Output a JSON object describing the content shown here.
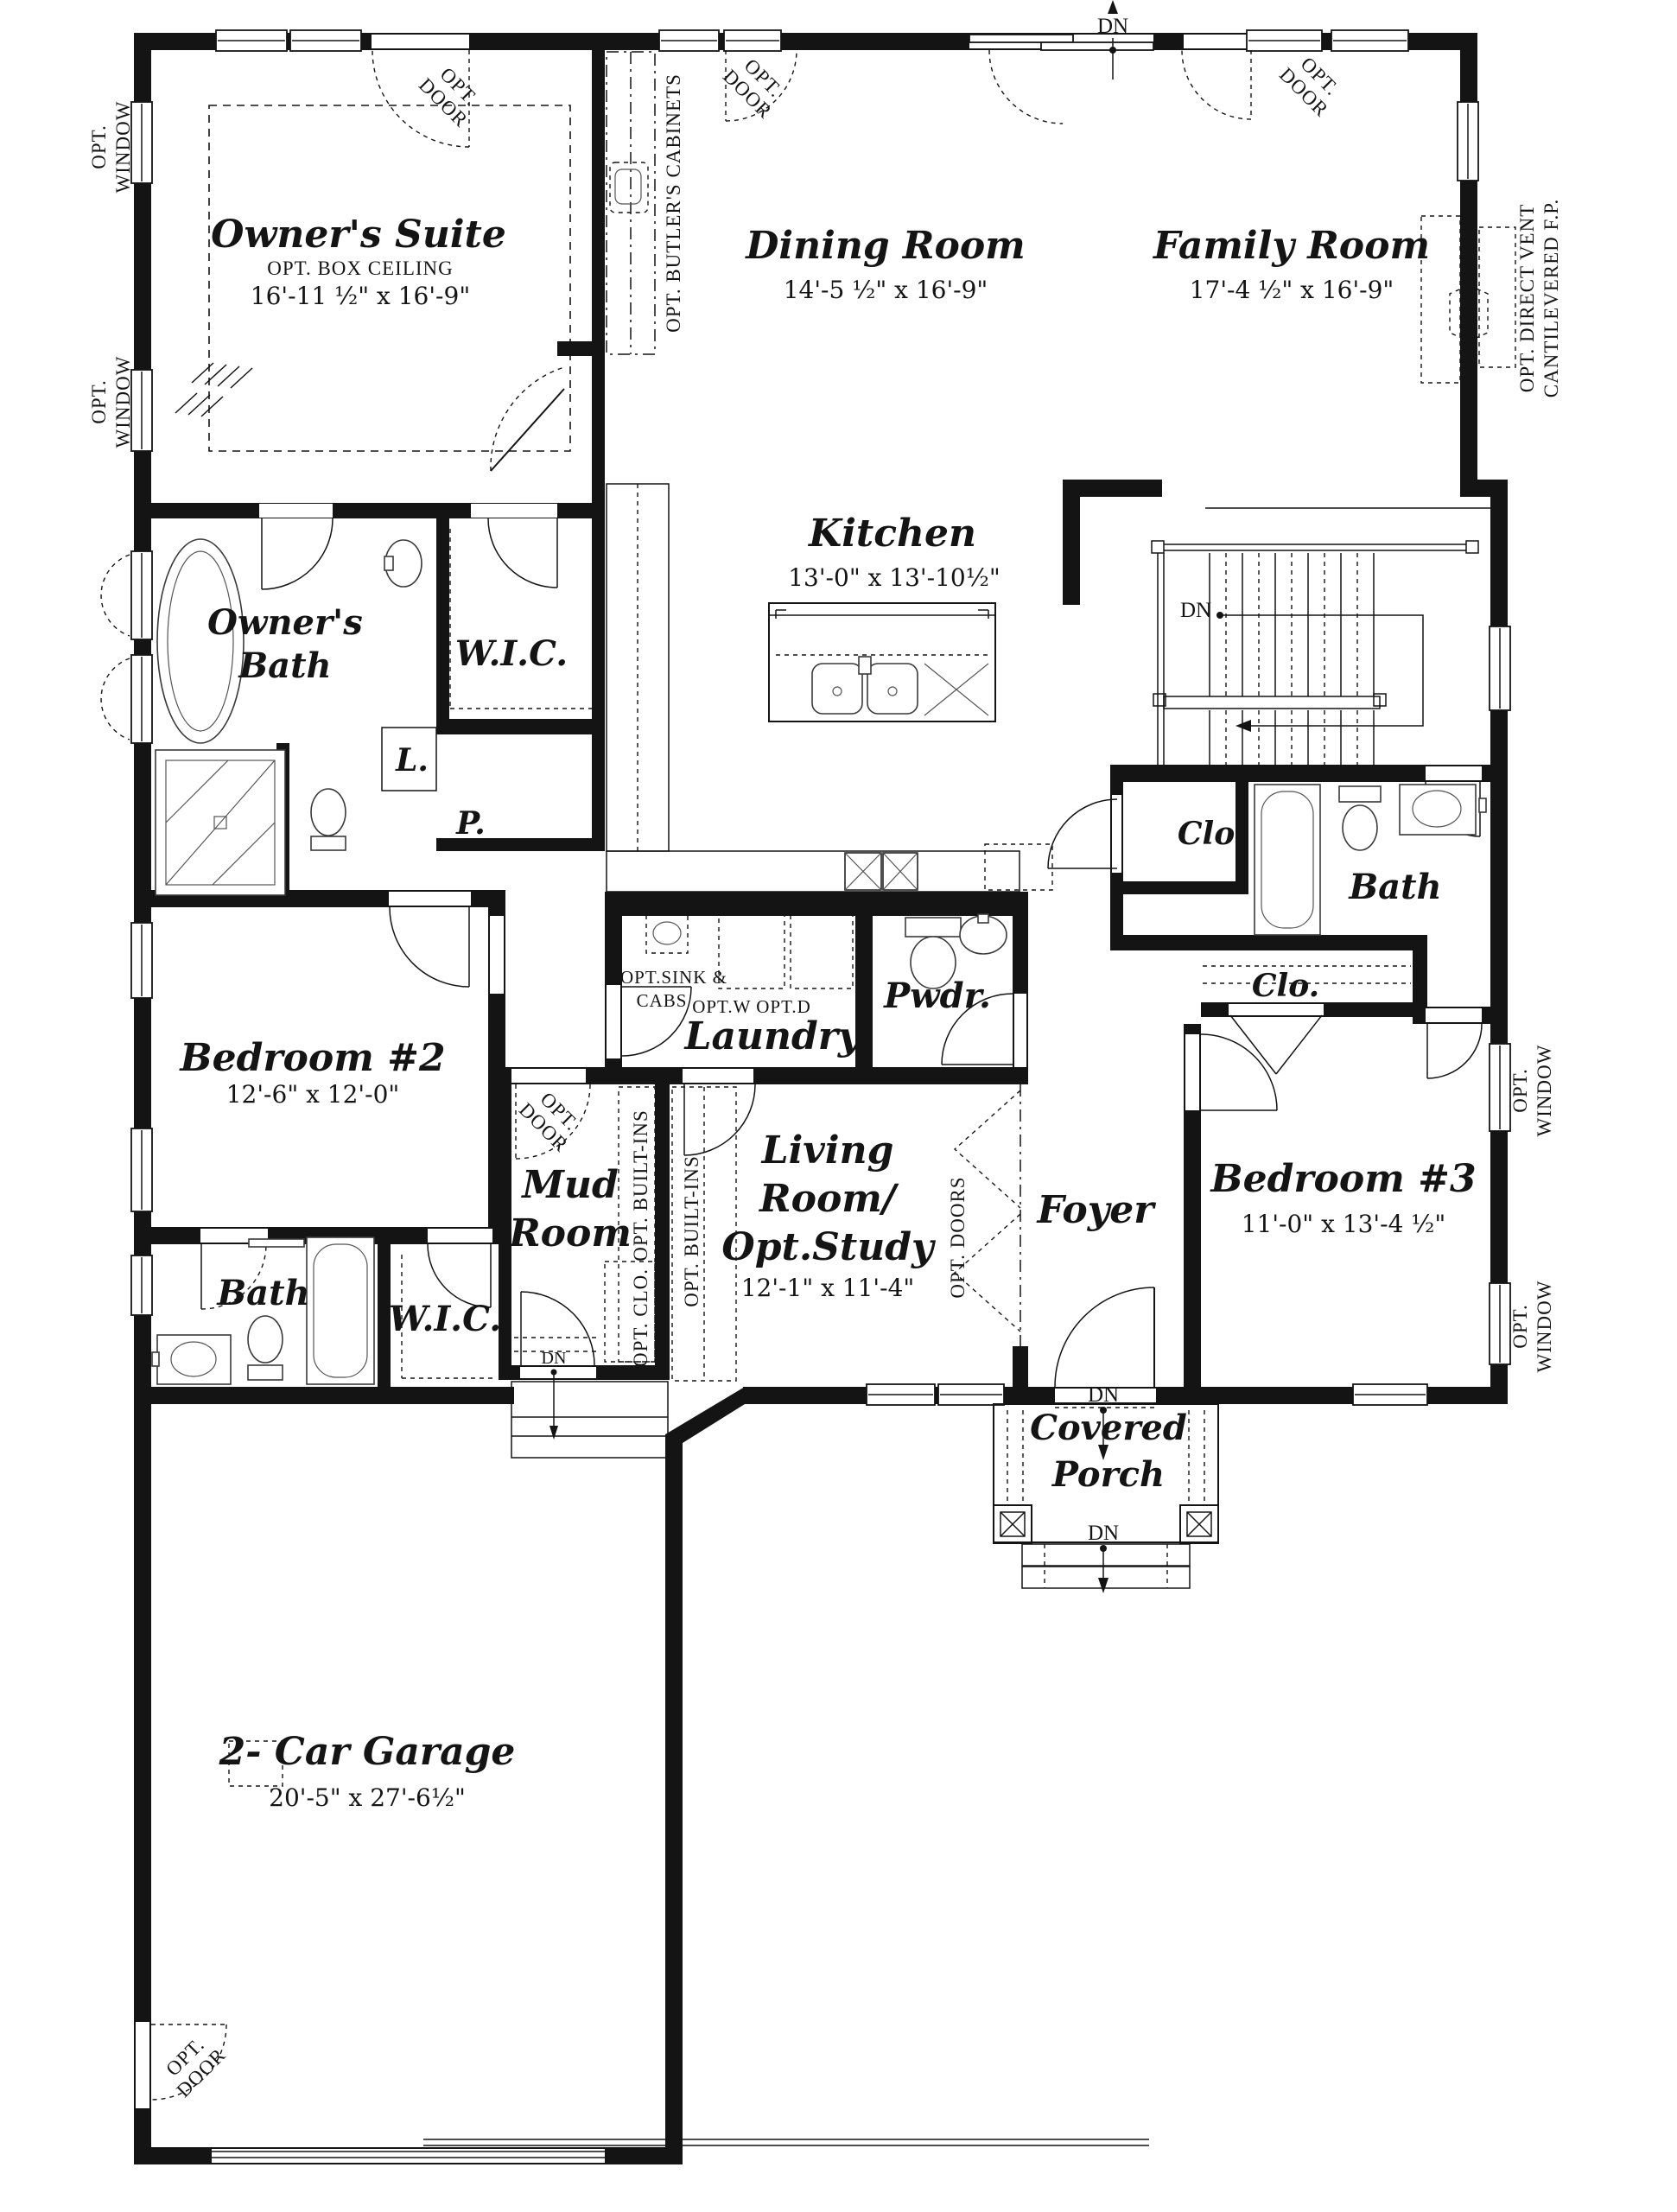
{
  "annotations": {
    "opt": "OPT.",
    "window": "WINDOW",
    "door": "DOOR",
    "doors_v": "OPT. DOORS",
    "builtins_v": "OPT. BUILT-INS",
    "clo_v": "OPT. CLO.",
    "butlers_v": "OPT.  BUTLER'S CABINETS",
    "fp_line1": "OPT. DIRECT VENT",
    "fp_line2": "CANTILEVERED F.P.",
    "dn": "DN",
    "box_ceiling": "OPT.  BOX CEILING",
    "sink_line1": "OPT.SINK &",
    "sink_line2": "CABS",
    "wd": "OPT.W OPT.D"
  },
  "rooms": {
    "owners_suite": {
      "name": "Owner's Suite",
      "dims": "16'-11 ½\" x 16'-9\""
    },
    "dining": {
      "name": "Dining Room",
      "dims": "14'-5 ½\" x 16'-9\""
    },
    "family": {
      "name": "Family Room",
      "dims": "17'-4 ½\" x 16'-9\""
    },
    "kitchen": {
      "name": "Kitchen",
      "dims": "13'-0\" x 13'-10½\""
    },
    "owners_bath": {
      "line1": "Owner's",
      "line2": "Bath"
    },
    "wic": {
      "name": "W.I.C."
    },
    "linen": {
      "name": "L."
    },
    "pantry": {
      "name": "P."
    },
    "bedroom2": {
      "name": "Bedroom #2",
      "dims": "12'-6\" x 12'-0\""
    },
    "bath": {
      "name": "Bath"
    },
    "mud": {
      "line1": "Mud",
      "line2": "Room"
    },
    "laundry": {
      "name": "Laundry"
    },
    "powder": {
      "name": "Pwdr."
    },
    "living": {
      "line1": "Living",
      "line2": "Room/",
      "line3": "Opt.Study",
      "dims": "12'-1\" x 11'-4\""
    },
    "foyer": {
      "name": "Foyer"
    },
    "bedroom3": {
      "name": "Bedroom #3",
      "dims": "11'-0\" x 13'-4 ½\""
    },
    "closet": {
      "name": "Clo."
    },
    "porch": {
      "line1": "Covered",
      "line2": "Porch"
    },
    "garage": {
      "name": "2- Car Garage",
      "dims": "20'-5\" x 27'-6½\""
    }
  }
}
